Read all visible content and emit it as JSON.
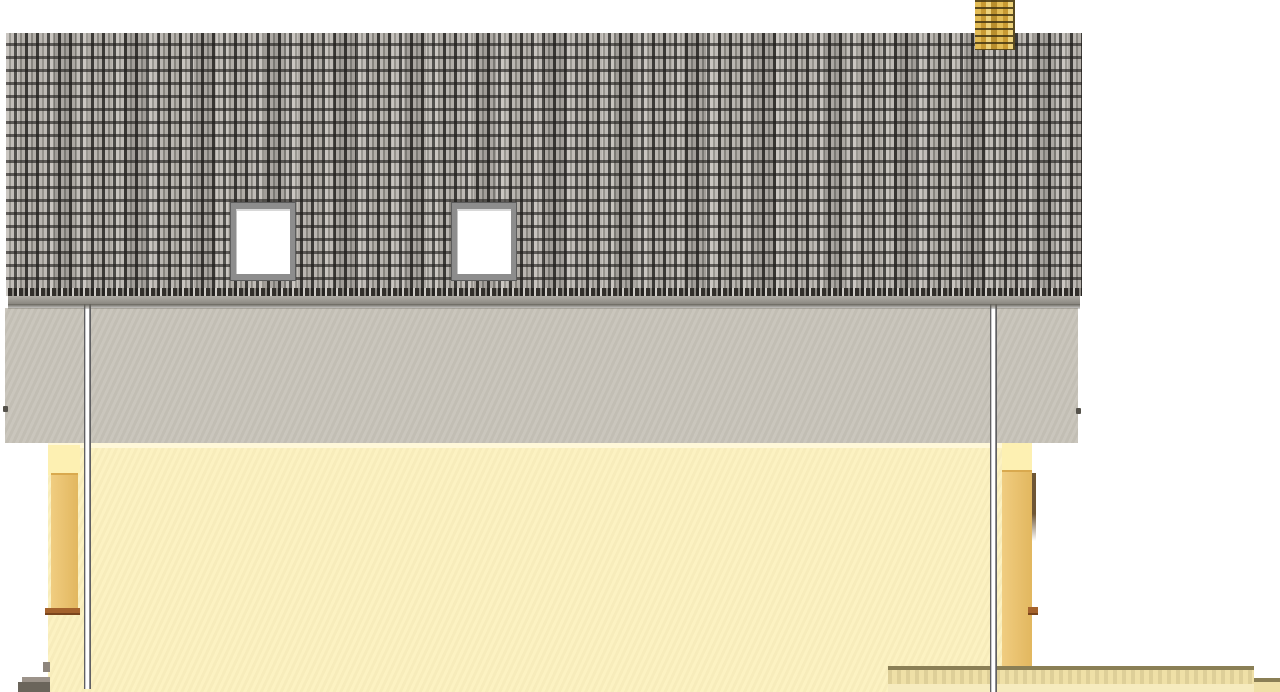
{
  "scene": {
    "type": "architectural-elevation",
    "view": "side-elevation",
    "roof": {
      "covering": "plain-tile",
      "skylights": 2,
      "chimneys": 1
    },
    "walls": {
      "attic_band": "grey-stucco",
      "facade": "pale-yellow-stucco"
    },
    "downpipes": 2,
    "steps_left": 1,
    "terrace_wall_right": 1,
    "visible_text": []
  },
  "colors": {
    "bg": "#ffffff",
    "attic-band": "#c8c4ba",
    "fascia-shadow": "#67645c",
    "ridge-light": "#b6b3ad",
    "ridge-dark": "#8f8c86",
    "tile-base": "#9b9892",
    "tile-light": "#c4c0ba",
    "tile-mid": "#8f8c86",
    "tile-dark": "#3f3d3a",
    "eave-dark": "#322f2b",
    "eave-light": "#cfccc7",
    "wall-yellow": "#fcf1bf",
    "wall-highlight": "#fff8d9",
    "corner-light": "#fdf0b2",
    "corner-gold": "#ecc676",
    "corner-edge": "#6e5636",
    "sill-brown": "#a4622c",
    "terrace-cap": "#8a7f55",
    "terrace-face": "#efe0a7",
    "terrace-foot": "#f6ebbf",
    "step-top": "#9c938a",
    "step-base": "#6b655b",
    "step-tab": "#8d857c",
    "pipe-light": "#ffffff",
    "pipe-mid": "#c9c9cb",
    "pipe-edge": "#606062",
    "chimney-gold": "#d2a93f",
    "chimney-light": "#eed27a",
    "chimney-dark": "#5a4a20",
    "skylight-frame": "#8d8d8d",
    "skylight-frame-dark": "#5c5c5c",
    "skylight-glass": "#ffffff",
    "anchor": "#55524b"
  }
}
